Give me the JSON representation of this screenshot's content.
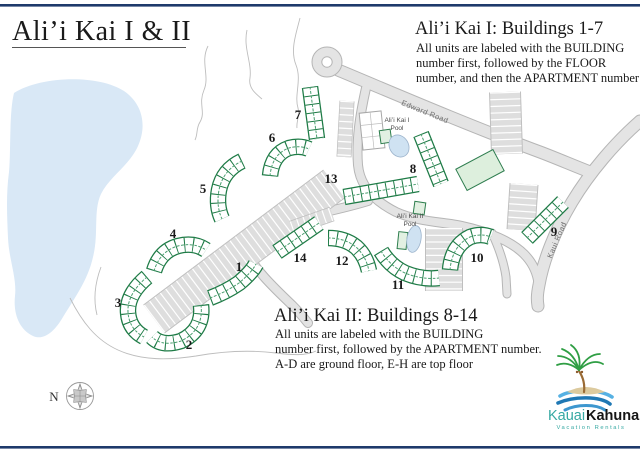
{
  "page": {
    "title": "Ali’i Kai I & II",
    "compass_label": "N"
  },
  "info_blocks": {
    "kai1": {
      "heading": "Ali’i Kai I: Buildings 1-7",
      "lines": [
        "All units are labeled with the BUILDING",
        "number first, followed by the FLOOR",
        "number, and then the APARTMENT number"
      ]
    },
    "kai2": {
      "heading": "Ali’i Kai II: Buildings 8-14",
      "lines": [
        "All units are labeled with the BUILDING",
        "number first, followed by the APARTMENT number.",
        "A-D are ground floor, E-H are top floor"
      ]
    }
  },
  "map": {
    "road_labels": {
      "edward": "Edward Road",
      "kaui": "Kaui Road"
    },
    "pool_labels": {
      "pool1_line1": "Ali’i Kai I",
      "pool1_line2": "Pool",
      "pool2_line1": "Ali’i Kai II",
      "pool2_line2": "Pool"
    },
    "building_labels": [
      "1",
      "2",
      "3",
      "4",
      "5",
      "6",
      "7",
      "8",
      "9",
      "10",
      "11",
      "12",
      "13",
      "14"
    ]
  },
  "logo": {
    "brand_first": "Kauai",
    "brand_second": "Kahuna",
    "tagline": "Vacation Rentals"
  },
  "colors": {
    "rule_navy": "#1e3a6b",
    "building_green": "#1e7b46",
    "pond_blue": "#d9e8f6",
    "road_gray": "#e4e4e4",
    "logo_teal": "#35a8a2"
  }
}
